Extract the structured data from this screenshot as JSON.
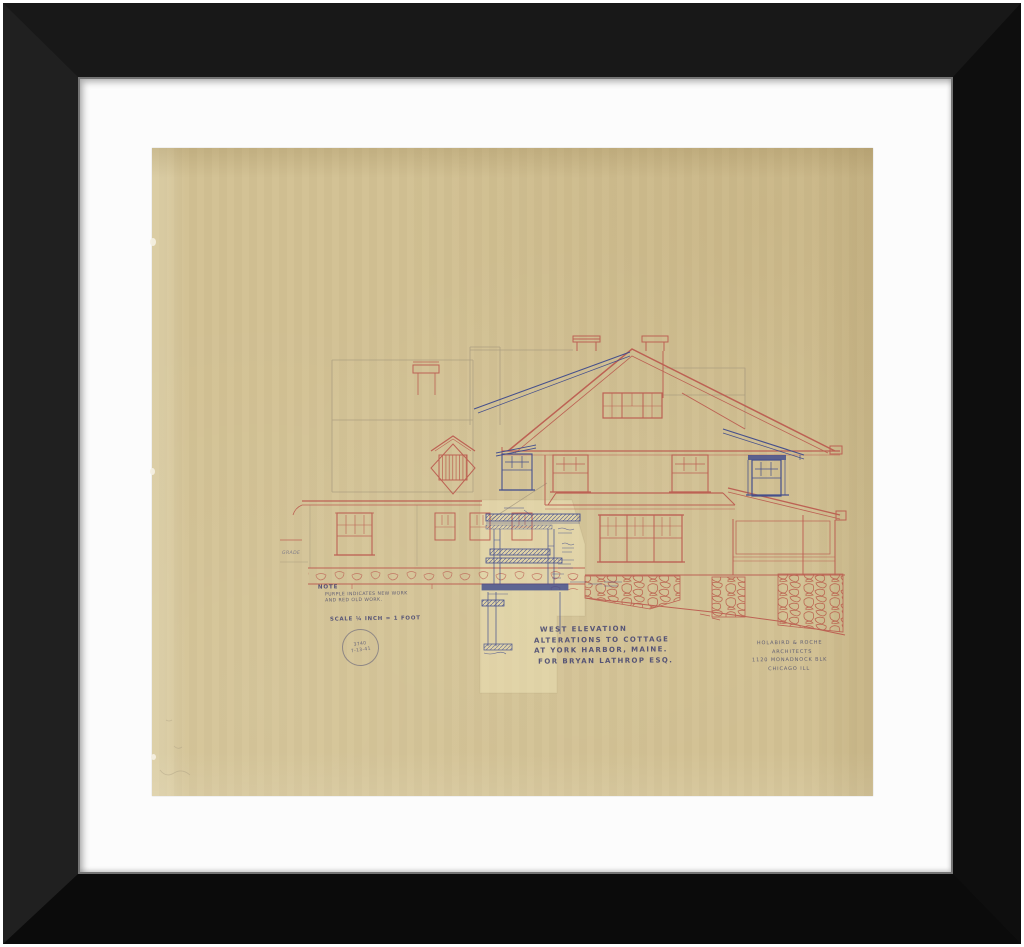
{
  "artwork": {
    "title_block": {
      "line1": "WEST ELEVATION",
      "line2": "ALTERATIONS TO COTTAGE",
      "line3": "AT YORK HARBOR, MAINE.",
      "line4": "FOR BRYAN LATHROP ESQ."
    },
    "note": {
      "title": "NOTE",
      "line1": "PURPLE INDICATES NEW WORK",
      "line2": "AND RED OLD WORK."
    },
    "scale_label": "SCALE ¼ INCH = 1 FOOT",
    "grade_label": "GRADE",
    "stamp": {
      "number": "3740",
      "date": "7-13-41"
    },
    "architect_block": {
      "line1": "HOLABIRD & ROCHE",
      "line2": "ARCHITECTS",
      "line3": "1120 MONADNOCK BLK",
      "line4": "CHICAGO ILL"
    },
    "palette": {
      "old_work_red": "#bb5a4f",
      "new_work_blue": "#3e4a8d",
      "pencil": "#a2957c",
      "ink": "#4b4b74",
      "paper": "#d2c193",
      "mat": "#fbfbfb",
      "frame": "#111111"
    }
  }
}
